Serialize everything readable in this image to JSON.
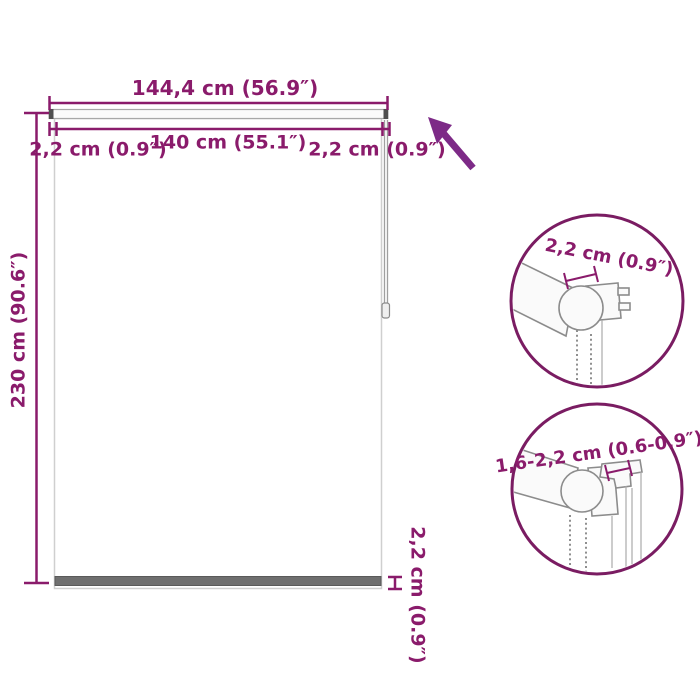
{
  "colors": {
    "dim": "#8a1b6b",
    "arrow": "#7d2a87",
    "circle_border": "#7a1c62",
    "blind_border": "#cfcfcf",
    "bottom_bar": "#6f6f6f",
    "chain": "#a0a0a0",
    "mech_outline": "#8c8c8c"
  },
  "labels": {
    "total_width": "144,4 cm (56.9″)",
    "left_margin": "2,2 cm (0.9″)",
    "inner_width": "140 cm (55.1″)",
    "right_margin": "2,2 cm (0.9″)",
    "height": "230 cm (90.6″)",
    "bottom_bar_height": "2,2 cm (0.9″)",
    "detail_top": "2,2 cm (0.9″)",
    "detail_bottom": "1,6-2,2 cm (0.6-0.9″)"
  }
}
